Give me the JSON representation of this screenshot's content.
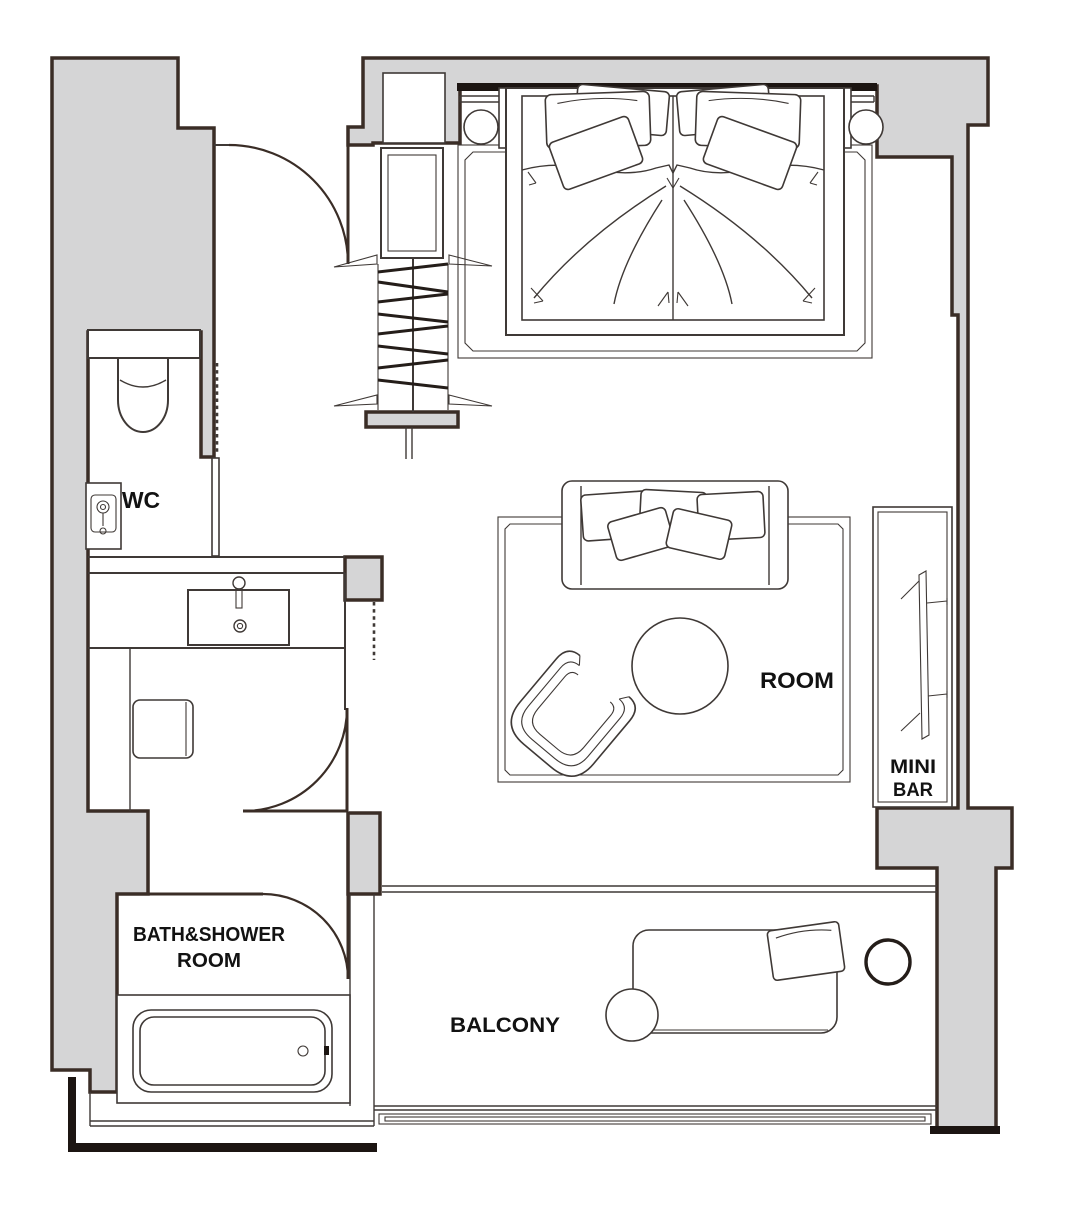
{
  "plan": {
    "type": "hotel-room-floor-plan",
    "labels": {
      "wc": "WC",
      "bath_shower_line1": "BATH&SHOWER",
      "bath_shower_line2": "ROOM",
      "balcony": "BALCONY",
      "room": "ROOM",
      "minibar_line1": "MINI",
      "minibar_line2": "BAR"
    },
    "colors": {
      "background": "#ffffff",
      "wall-fill": "#d5d5d6",
      "wall-stroke": "#3a2d26",
      "line": "#3f3936",
      "text": "#121212"
    }
  }
}
